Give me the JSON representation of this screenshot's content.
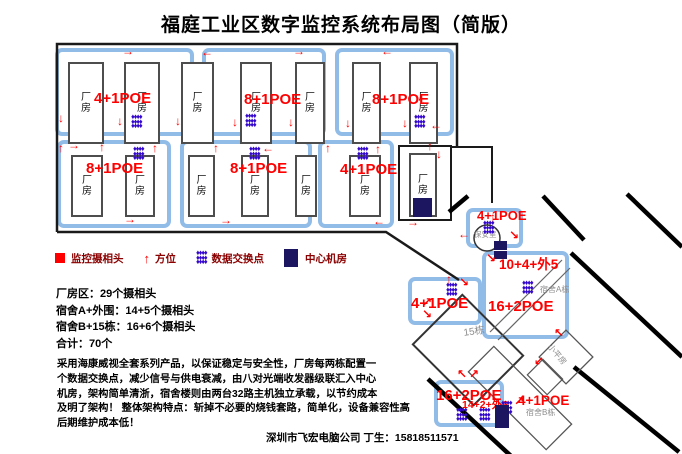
{
  "title": "福庭工业区数字监控系统布局图（简版）",
  "legend": {
    "camera_label": "监控摄相头",
    "direction_label": "方位",
    "direction_glyph": "↑",
    "switch_label": "数据交换点",
    "server_label": "中心机房"
  },
  "stats": {
    "line1": "厂房区：29个摄相头",
    "line2": "宿舍A+外围：14+5个摄相头",
    "line3": "宿舍B+15栋：16+6个摄相头",
    "line4": "合计：70个"
  },
  "description": [
    "采用海康威视全套系列产品，以保证稳定与安全性，厂房每两栋配置一",
    "个数据交换点，减少信号与供电衰减，由八对光端收发器级联汇入中心",
    "机房，架构简单清浙，宿舍楼则由两台32路主机独立承载，以节约成本",
    "及明了架构！ 整体架构特点：斩掉不必要的烧钱套路，简单化，设备兼容性高",
    "后期维护成本低！"
  ],
  "footer": "深圳市飞宏电脑公司 丁生：15818511571",
  "colors": {
    "accent_red": "#FF0000",
    "legend_maroon": "#8B0000",
    "switch_purple": "#3407CC",
    "server_navy": "#1C1660",
    "block_blue": "#92BCE8",
    "room_border": "#4D4D4D",
    "grey_label": "#8C8C8C"
  },
  "icons": {
    "switch_glyph": "♦"
  },
  "diagram": {
    "room_label": "厂房",
    "blocks": [
      [
        55,
        48,
        139,
        88
      ],
      [
        202,
        48,
        124,
        88
      ],
      [
        335,
        48,
        119,
        88
      ],
      [
        57,
        140,
        114,
        88
      ],
      [
        180,
        140,
        132,
        88
      ],
      [
        318,
        140,
        76,
        88
      ],
      [
        466,
        208,
        57,
        40
      ],
      [
        482,
        251,
        87,
        88
      ],
      [
        408,
        277,
        74,
        48
      ],
      [
        434,
        380,
        70,
        47
      ]
    ],
    "rooms": [
      [
        68,
        62,
        36,
        82
      ],
      [
        124,
        62,
        36,
        82
      ],
      [
        181,
        62,
        33,
        82
      ],
      [
        240,
        62,
        32,
        82
      ],
      [
        295,
        62,
        30,
        82
      ],
      [
        352,
        62,
        29,
        82
      ],
      [
        409,
        62,
        29,
        82
      ],
      [
        71,
        155,
        32,
        62
      ],
      [
        125,
        155,
        30,
        62
      ],
      [
        188,
        155,
        27,
        62
      ],
      [
        241,
        155,
        28,
        62
      ],
      [
        295,
        155,
        22,
        62
      ],
      [
        349,
        155,
        32,
        62
      ],
      [
        409,
        153,
        28,
        64
      ]
    ],
    "poe_labels": [
      [
        94,
        91,
        15,
        "4+1POE"
      ],
      [
        244,
        92,
        15,
        "8+1POE"
      ],
      [
        372,
        92,
        15,
        "8+1POE"
      ],
      [
        86,
        161,
        15,
        "8+1POE"
      ],
      [
        230,
        161,
        15,
        "8+1POE"
      ],
      [
        340,
        162,
        15,
        "4+1POE"
      ],
      [
        477,
        209,
        13,
        "4+1POE"
      ],
      [
        499,
        258,
        13.5,
        "10+4+外5"
      ],
      [
        488,
        299,
        15,
        "16+2POE"
      ],
      [
        411,
        296,
        15,
        "4+1POE"
      ],
      [
        436,
        388,
        15,
        "16+2POE"
      ],
      [
        462,
        400,
        10.5,
        "14+2+外6"
      ],
      [
        518,
        394,
        13.5,
        "4+1POE"
      ]
    ],
    "grey_labels": [
      [
        474,
        231,
        7.5,
        0,
        "保安室"
      ],
      [
        540,
        286,
        8,
        0,
        "宿舍A栋"
      ],
      [
        463,
        329,
        10,
        -8,
        "15栋"
      ],
      [
        552,
        343,
        8,
        50,
        "小平房"
      ],
      [
        526,
        409,
        8,
        0,
        "宿舍B栋"
      ]
    ],
    "clusters": [
      [
        131,
        115
      ],
      [
        245,
        114
      ],
      [
        414,
        115
      ],
      [
        133,
        147
      ],
      [
        249,
        147
      ],
      [
        357,
        147
      ],
      [
        483,
        221
      ],
      [
        522,
        281
      ],
      [
        446,
        283
      ],
      [
        456,
        408
      ],
      [
        479,
        408
      ],
      [
        501,
        401
      ]
    ],
    "navy_squares": [
      [
        413,
        198,
        19,
        19
      ],
      [
        494,
        241,
        13,
        9
      ],
      [
        494,
        251,
        13,
        8
      ],
      [
        495,
        405,
        14,
        23
      ]
    ],
    "arrows": [
      [
        122,
        46,
        "→"
      ],
      [
        201,
        47,
        "←"
      ],
      [
        293,
        46,
        "→"
      ],
      [
        381,
        46,
        "←"
      ],
      [
        58,
        113,
        "↓"
      ],
      [
        117,
        116,
        "↓"
      ],
      [
        175,
        116,
        "↓"
      ],
      [
        232,
        117,
        "↓"
      ],
      [
        288,
        117,
        "↓"
      ],
      [
        345,
        118,
        "↓"
      ],
      [
        402,
        118,
        "↓"
      ],
      [
        430,
        120,
        "←"
      ],
      [
        58,
        143,
        "↑"
      ],
      [
        68,
        140,
        "→"
      ],
      [
        99,
        142,
        "↑"
      ],
      [
        152,
        143,
        "↑"
      ],
      [
        213,
        143,
        "↑"
      ],
      [
        262,
        143,
        "←"
      ],
      [
        325,
        143,
        "↑"
      ],
      [
        375,
        144,
        "↑"
      ],
      [
        427,
        141,
        "↑"
      ],
      [
        436,
        149,
        "↓"
      ],
      [
        124,
        214,
        "→"
      ],
      [
        220,
        215,
        "→"
      ],
      [
        373,
        216,
        "←"
      ],
      [
        407,
        217,
        "→"
      ],
      [
        490,
        212,
        "↑"
      ],
      [
        458,
        229,
        "←"
      ],
      [
        509,
        230,
        "↘"
      ],
      [
        486,
        253,
        "↘"
      ],
      [
        554,
        328,
        "↖"
      ],
      [
        446,
        274,
        "↑"
      ],
      [
        459,
        277,
        "↘"
      ],
      [
        422,
        297,
        "↗"
      ],
      [
        422,
        309,
        "↘"
      ],
      [
        534,
        356,
        "↙"
      ],
      [
        457,
        369,
        "↖"
      ],
      [
        469,
        369,
        "↗"
      ],
      [
        481,
        392,
        "↑"
      ],
      [
        514,
        396,
        "↗"
      ]
    ]
  }
}
